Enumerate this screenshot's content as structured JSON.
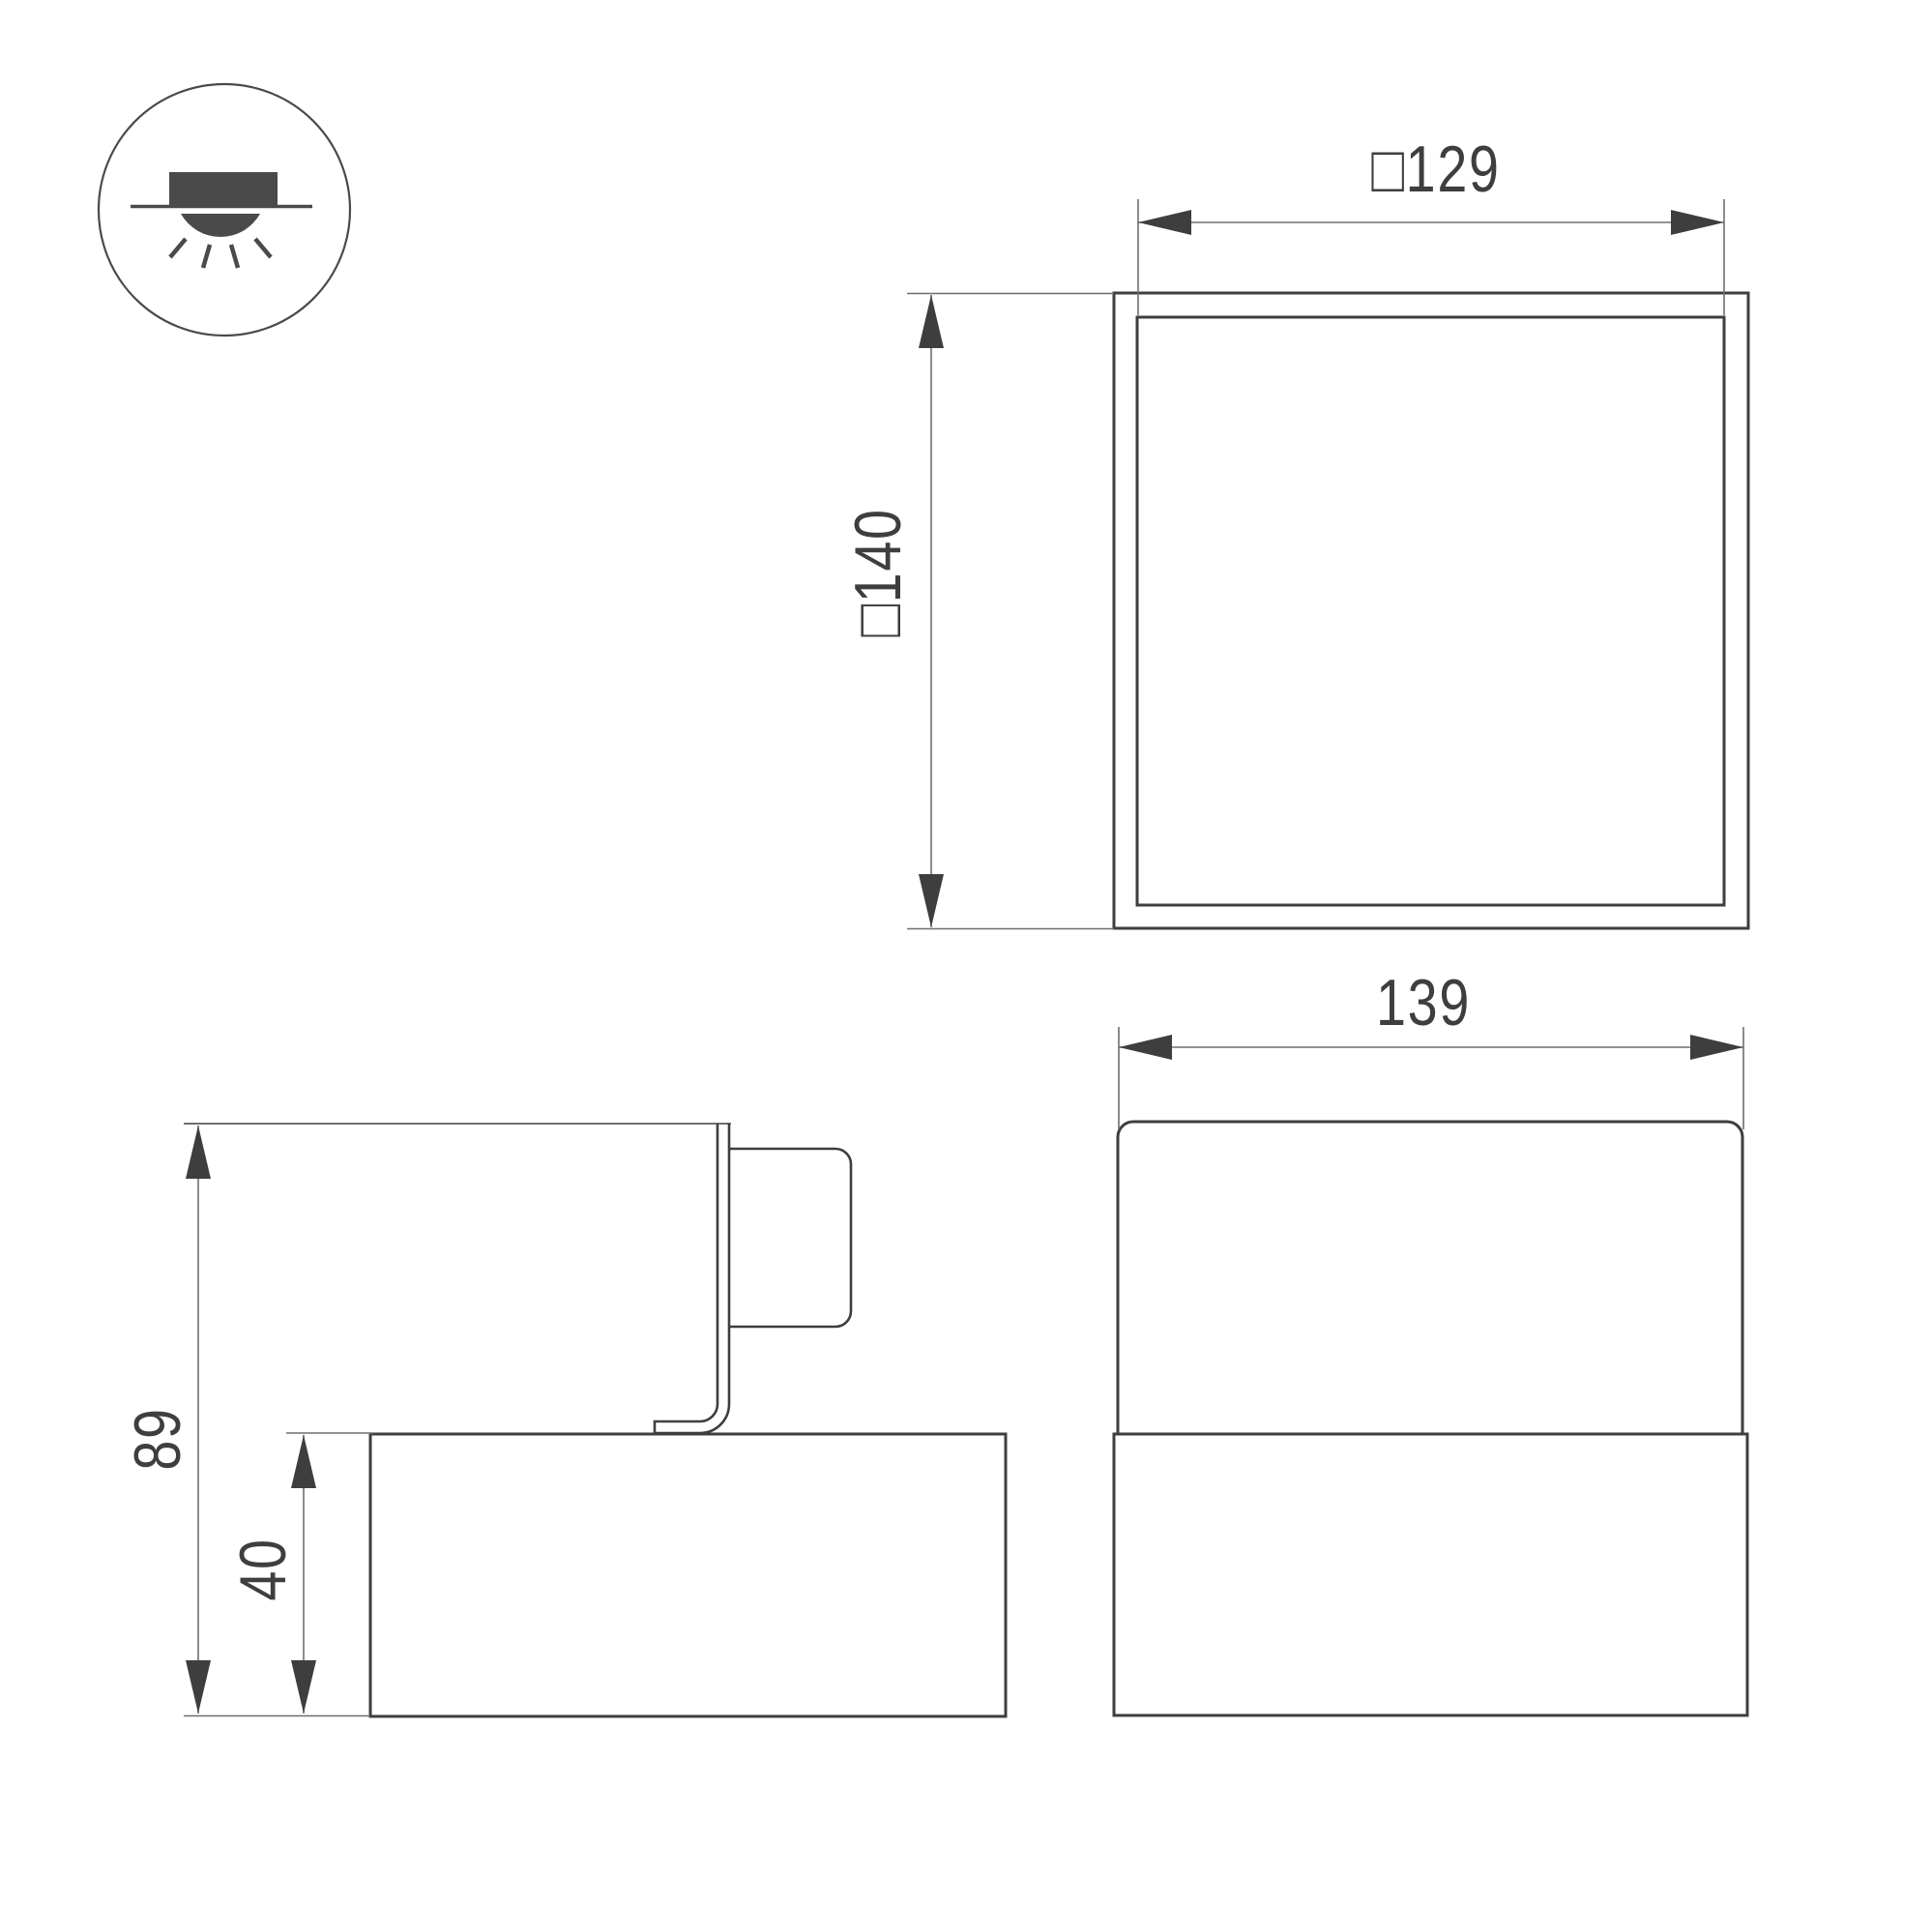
{
  "drawing": {
    "type": "luminaire-dimension-drawing",
    "background": "#ffffff",
    "colors": {
      "object_line": "#3e3e3e",
      "thin_line": "#6f6f6f",
      "icon_line": "#4a4a4a",
      "text": "#3e3e3e"
    },
    "icon": {
      "name": "surface-mount-downlight-icon"
    },
    "views": {
      "top_view": {
        "dimensions": {
          "inner_width": {
            "label": "□129"
          },
          "outer_height": {
            "label": "□140"
          }
        }
      },
      "front_view": {
        "dimensions": {
          "width": {
            "label": "139"
          }
        }
      },
      "side_view": {
        "dimensions": {
          "total_height": {
            "label": "89"
          },
          "body_height": {
            "label": "40"
          }
        }
      }
    }
  }
}
